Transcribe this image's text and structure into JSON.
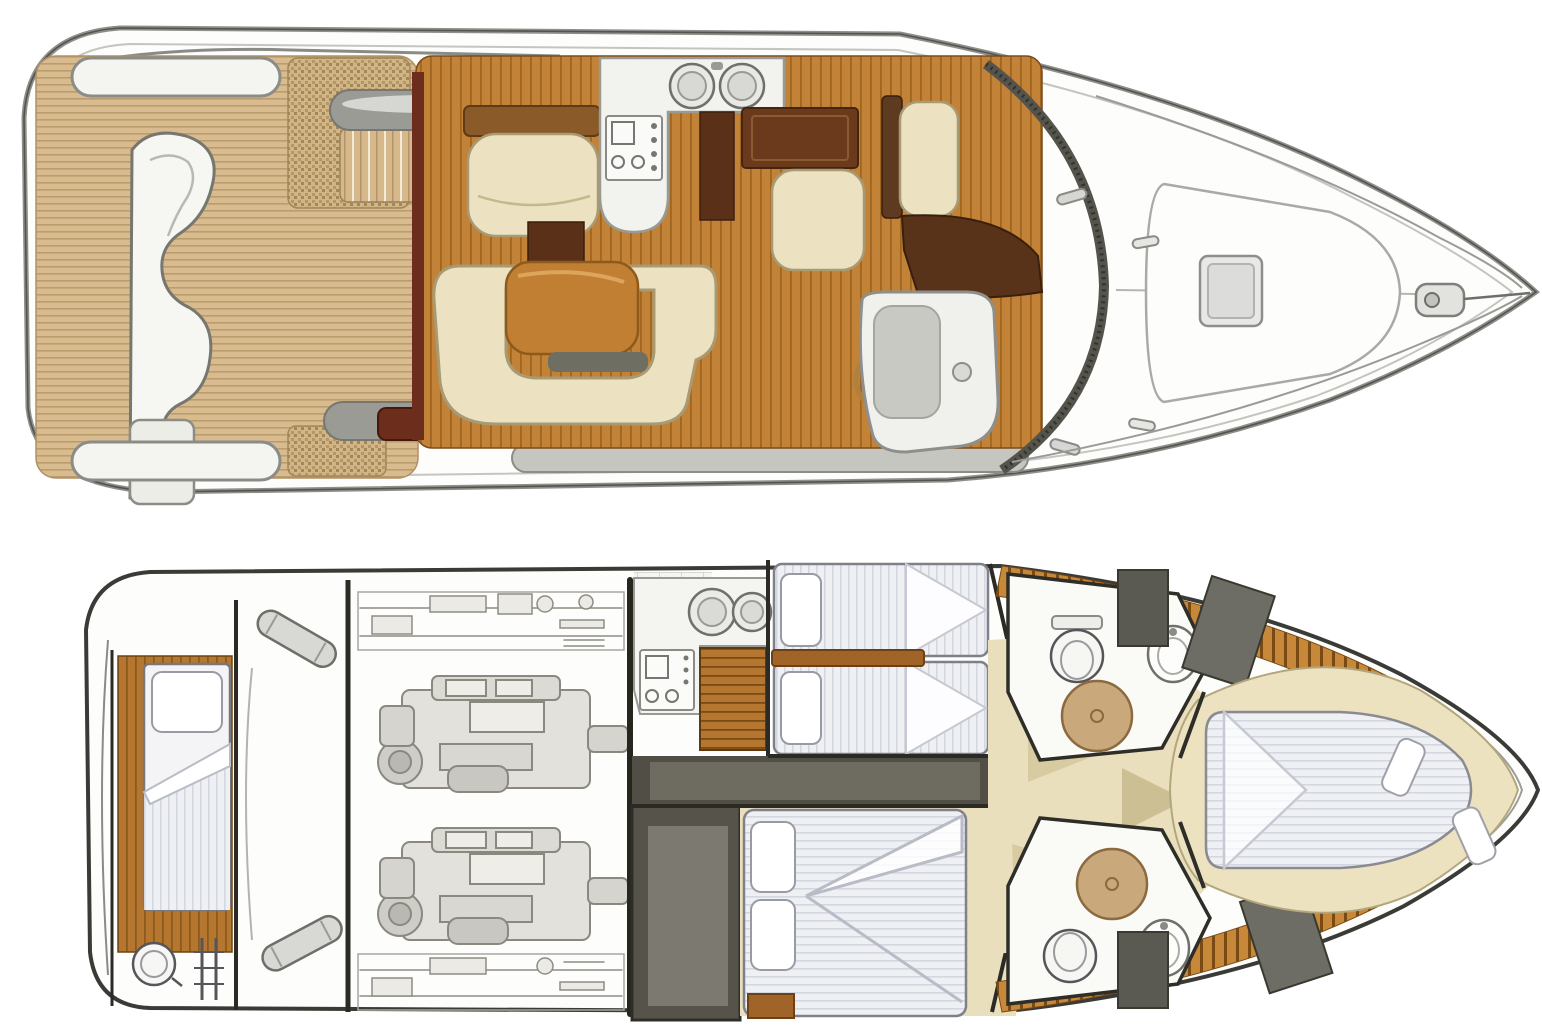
{
  "document": {
    "title": "Motor yacht deck plan – two-level layout drawing",
    "views": [
      {
        "id": "main-deck",
        "label": "main deck exterior and salon"
      },
      {
        "id": "lower-deck",
        "label": "lower deck accommodations and engine room"
      }
    ]
  },
  "palette": {
    "hull_white": "#fdfdfb",
    "hull_line": "#8e8e8a",
    "hull_dark": "#55544e",
    "black_wall": "#2b2a25",
    "teak": "#d8bb8e",
    "weave_dot": "#a2875a",
    "salon_wood": "#c28238",
    "walnut": "#5e3a20",
    "maroon": "#6d2d1d",
    "cream": "#ece2c2",
    "cream_line": "#a89a72",
    "table": "#c17f33",
    "table_shadow": "#6f6e62",
    "gray_pill": "#9b9b95",
    "gray_light": "#d6d6d2",
    "pad_white": "#f4f4f1",
    "dash_wood": "#58331a",
    "wheel": "#b08040",
    "seat_gray": "#c9c9c4",
    "windshield": "#4c4b45",
    "corridor": "#514f45",
    "wardrobe": "#56544a",
    "wardrobe_inner": "#7b7970",
    "beige": "#e9dfbd",
    "beige_shade": "#cdbf94",
    "mattress": "#eef0f4",
    "pillow": "#ffffff",
    "pillow_line": "#9a9aa4",
    "fold_line": "#b9bcc6",
    "shower": "#c9a97c",
    "shower_line": "#8a6a3e",
    "panel_gray": "#5b5a52",
    "engine_fill": "#e3e1db",
    "engine_line": "#8a887f",
    "fixture_line": "#55555a",
    "step_wood": "#a06428"
  },
  "main_deck": {
    "features": {
      "swim_platform": "teak swim platform with curved lounger",
      "cockpit": "teak cockpit with woven sunpad and side steps",
      "galley": {
        "sinks": 2,
        "stove_burners": 2
      },
      "salon": "U-shaped settee with table, aft settee, sideboard",
      "helm": "helm seat, steering wheel, co-pilot seat",
      "foredeck": {
        "hatch": 1,
        "sunpad": 1,
        "windlass": 1,
        "cleats": 4
      }
    }
  },
  "lower_deck": {
    "features": {
      "aft_cabin": {
        "beds": 1,
        "porthole": 1,
        "ladder": 1
      },
      "engine_room": {
        "engines": 2
      },
      "galley": {
        "sinks": 2,
        "stove_burners": 2
      },
      "twin_cabin": {
        "beds": 2
      },
      "mid_cabin": {
        "beds": 1
      },
      "heads": {
        "count": 2,
        "toilet": 1,
        "shower": 1,
        "sink": 1
      },
      "vip_cabin": {
        "beds": 1,
        "pillows": 2
      }
    }
  }
}
